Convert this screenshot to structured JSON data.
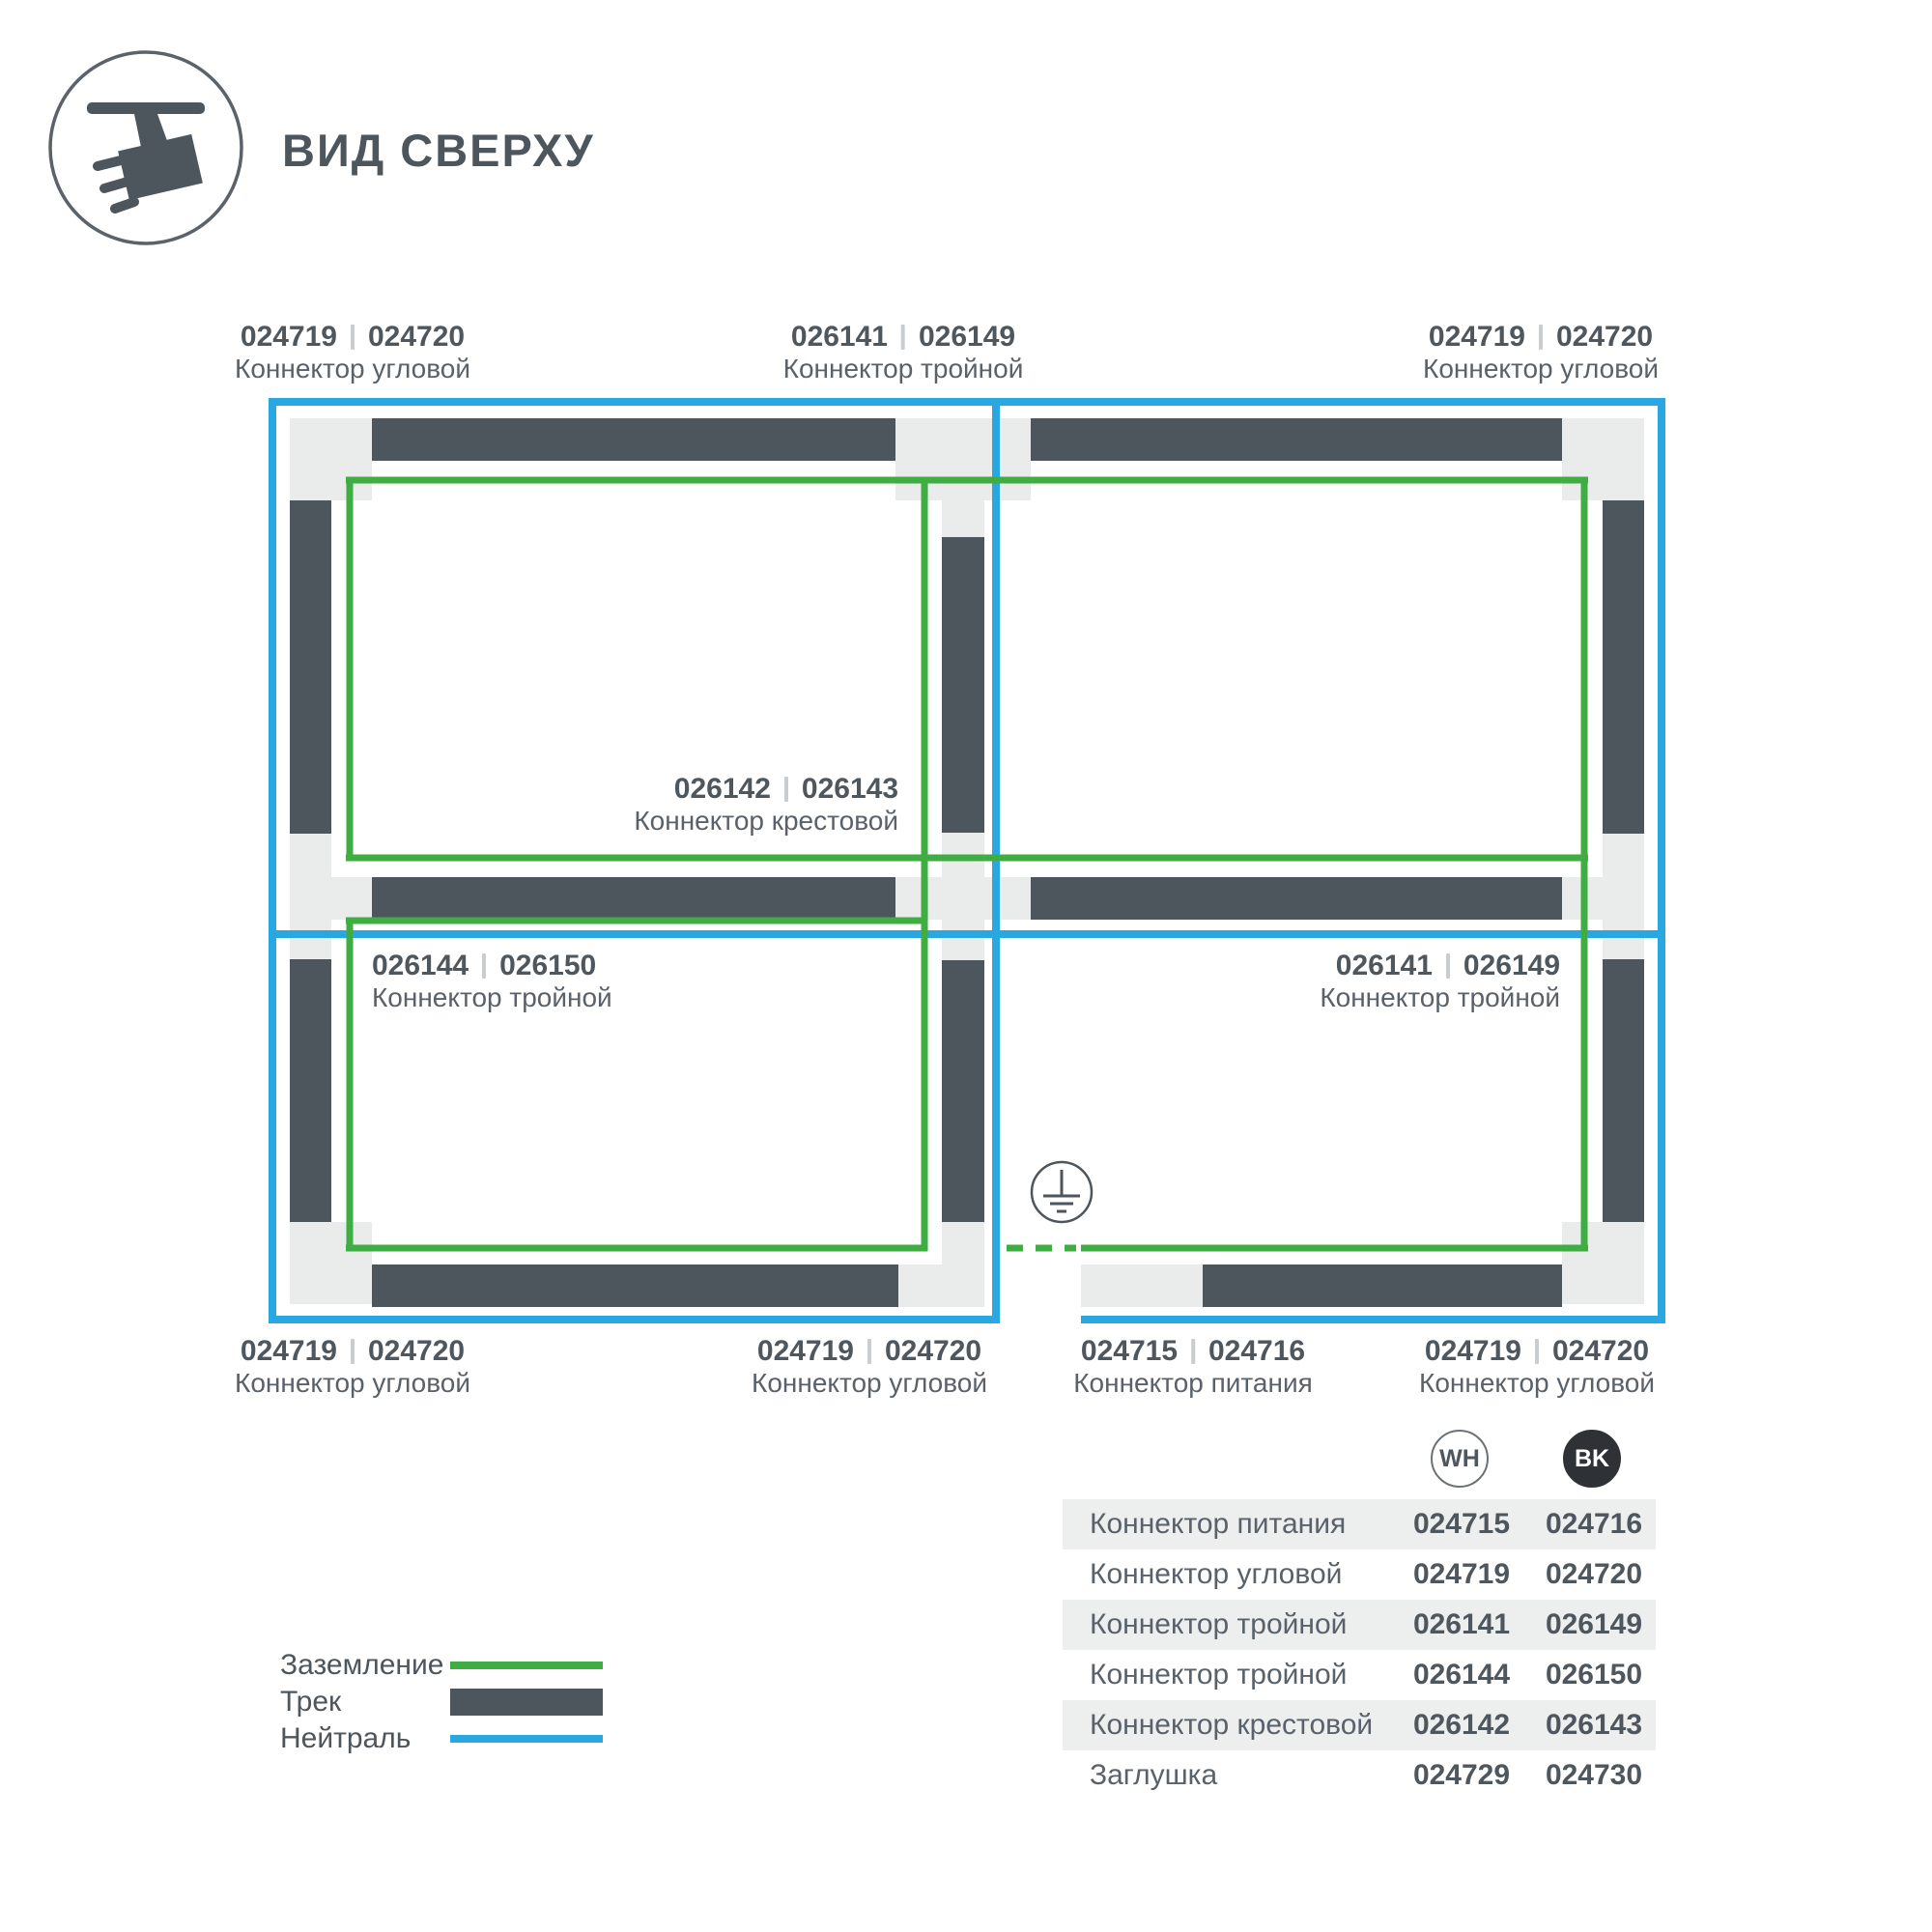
{
  "header": {
    "title": "ВИД СВЕРХУ"
  },
  "colors": {
    "ground": "#3fad42",
    "track": "#4d555d",
    "neutral": "#29a7e0",
    "connector_block": "#eaecec"
  },
  "diagram_labels": [
    {
      "codes": [
        "024719",
        "024720"
      ],
      "name": "Коннектор угловой"
    },
    {
      "codes": [
        "026141",
        "026149"
      ],
      "name": "Коннектор тройной"
    },
    {
      "codes": [
        "024719",
        "024720"
      ],
      "name": "Коннектор угловой"
    },
    {
      "codes": [
        "026142",
        "026143"
      ],
      "name": "Коннектор крестовой"
    },
    {
      "codes": [
        "026144",
        "026150"
      ],
      "name": "Коннектор тройной"
    },
    {
      "codes": [
        "026141",
        "026149"
      ],
      "name": "Коннектор тройной"
    },
    {
      "codes": [
        "024719",
        "024720"
      ],
      "name": "Коннектор угловой"
    },
    {
      "codes": [
        "024719",
        "024720"
      ],
      "name": "Коннектор угловой"
    },
    {
      "codes": [
        "024715",
        "024716"
      ],
      "name": "Коннектор питания"
    },
    {
      "codes": [
        "024719",
        "024720"
      ],
      "name": "Коннектор угловой"
    }
  ],
  "legend": [
    {
      "label": "Заземление",
      "swatch": "ground-line"
    },
    {
      "label": "Трек",
      "swatch": "track-bar"
    },
    {
      "label": "Нейтраль",
      "swatch": "neutral-line"
    }
  ],
  "table": {
    "columns": [
      {
        "code": "WH"
      },
      {
        "code": "BK"
      }
    ],
    "rows": [
      {
        "name": "Коннектор питания",
        "wh": "024715",
        "bk": "024716"
      },
      {
        "name": "Коннектор угловой",
        "wh": "024719",
        "bk": "024720"
      },
      {
        "name": "Коннектор тройной",
        "wh": "026141",
        "bk": "026149"
      },
      {
        "name": "Коннектор тройной",
        "wh": "026144",
        "bk": "026150"
      },
      {
        "name": "Коннектор крестовой",
        "wh": "026142",
        "bk": "026143"
      },
      {
        "name": "Заглушка",
        "wh": "024729",
        "bk": "024730"
      }
    ]
  }
}
